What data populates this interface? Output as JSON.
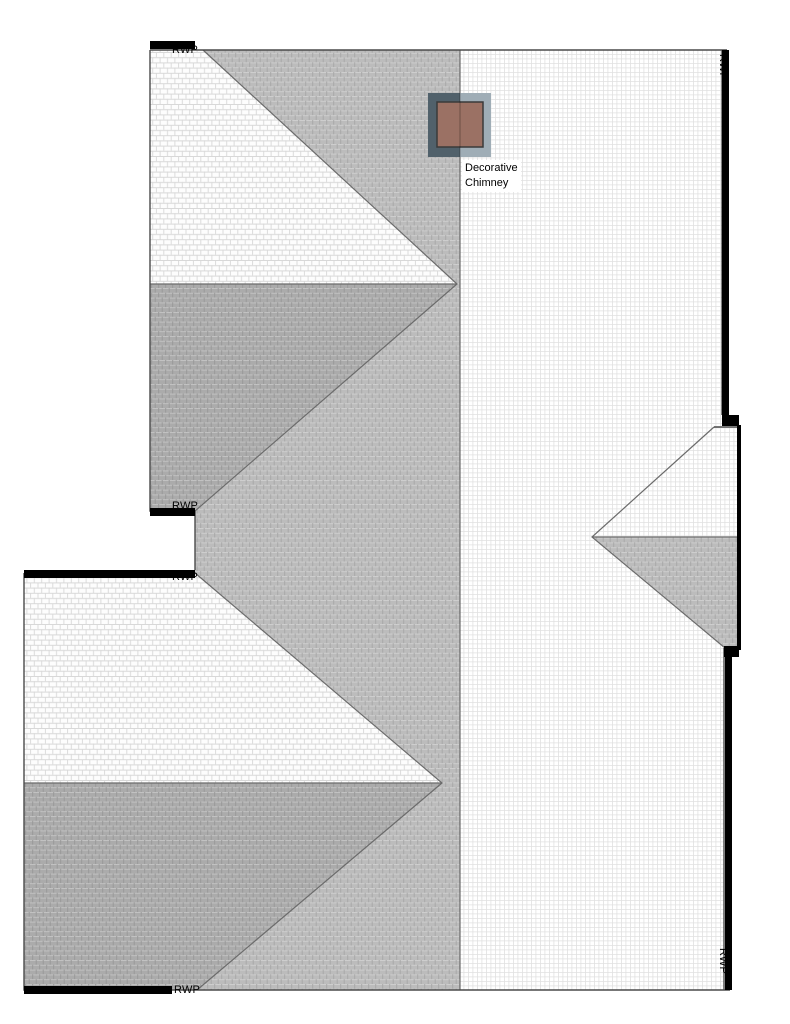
{
  "labels": {
    "rwp_top_left": "RWP",
    "rwp_notch_upper": "RWP",
    "rwp_notch_lower": "RWP",
    "rwp_bottom_left": "RWP",
    "rwp_right_top": "RWP",
    "rwp_right_bottom": "RWP"
  },
  "annotations": {
    "chimney_line1": "Decorative",
    "chimney_line2": "Chimney"
  },
  "colors": {
    "roof_east_bg": "#ffffff",
    "roof_east_grid": "#e0e0e0",
    "roof_west_bg": "#bcbcbc",
    "roof_west_grid": "#cecece",
    "roof_west_tick": "#a9a9a9",
    "wing_north_bg": "#fdfdfd",
    "wing_north_grid": "#d8d8d8",
    "wing_south_bg": "#ababab",
    "wing_south_grid": "#c2c2c2",
    "wing_south_tick": "#999999",
    "outline": "#4a4a4a",
    "ridge_line": "#6b6b6b",
    "eave_bar": "#000000",
    "chimney_frame_left": "#51616b",
    "chimney_frame_right": "#9fadb6",
    "chimney_brown": "#9b7164",
    "chimney_inner_border": "#3a3a3a"
  }
}
